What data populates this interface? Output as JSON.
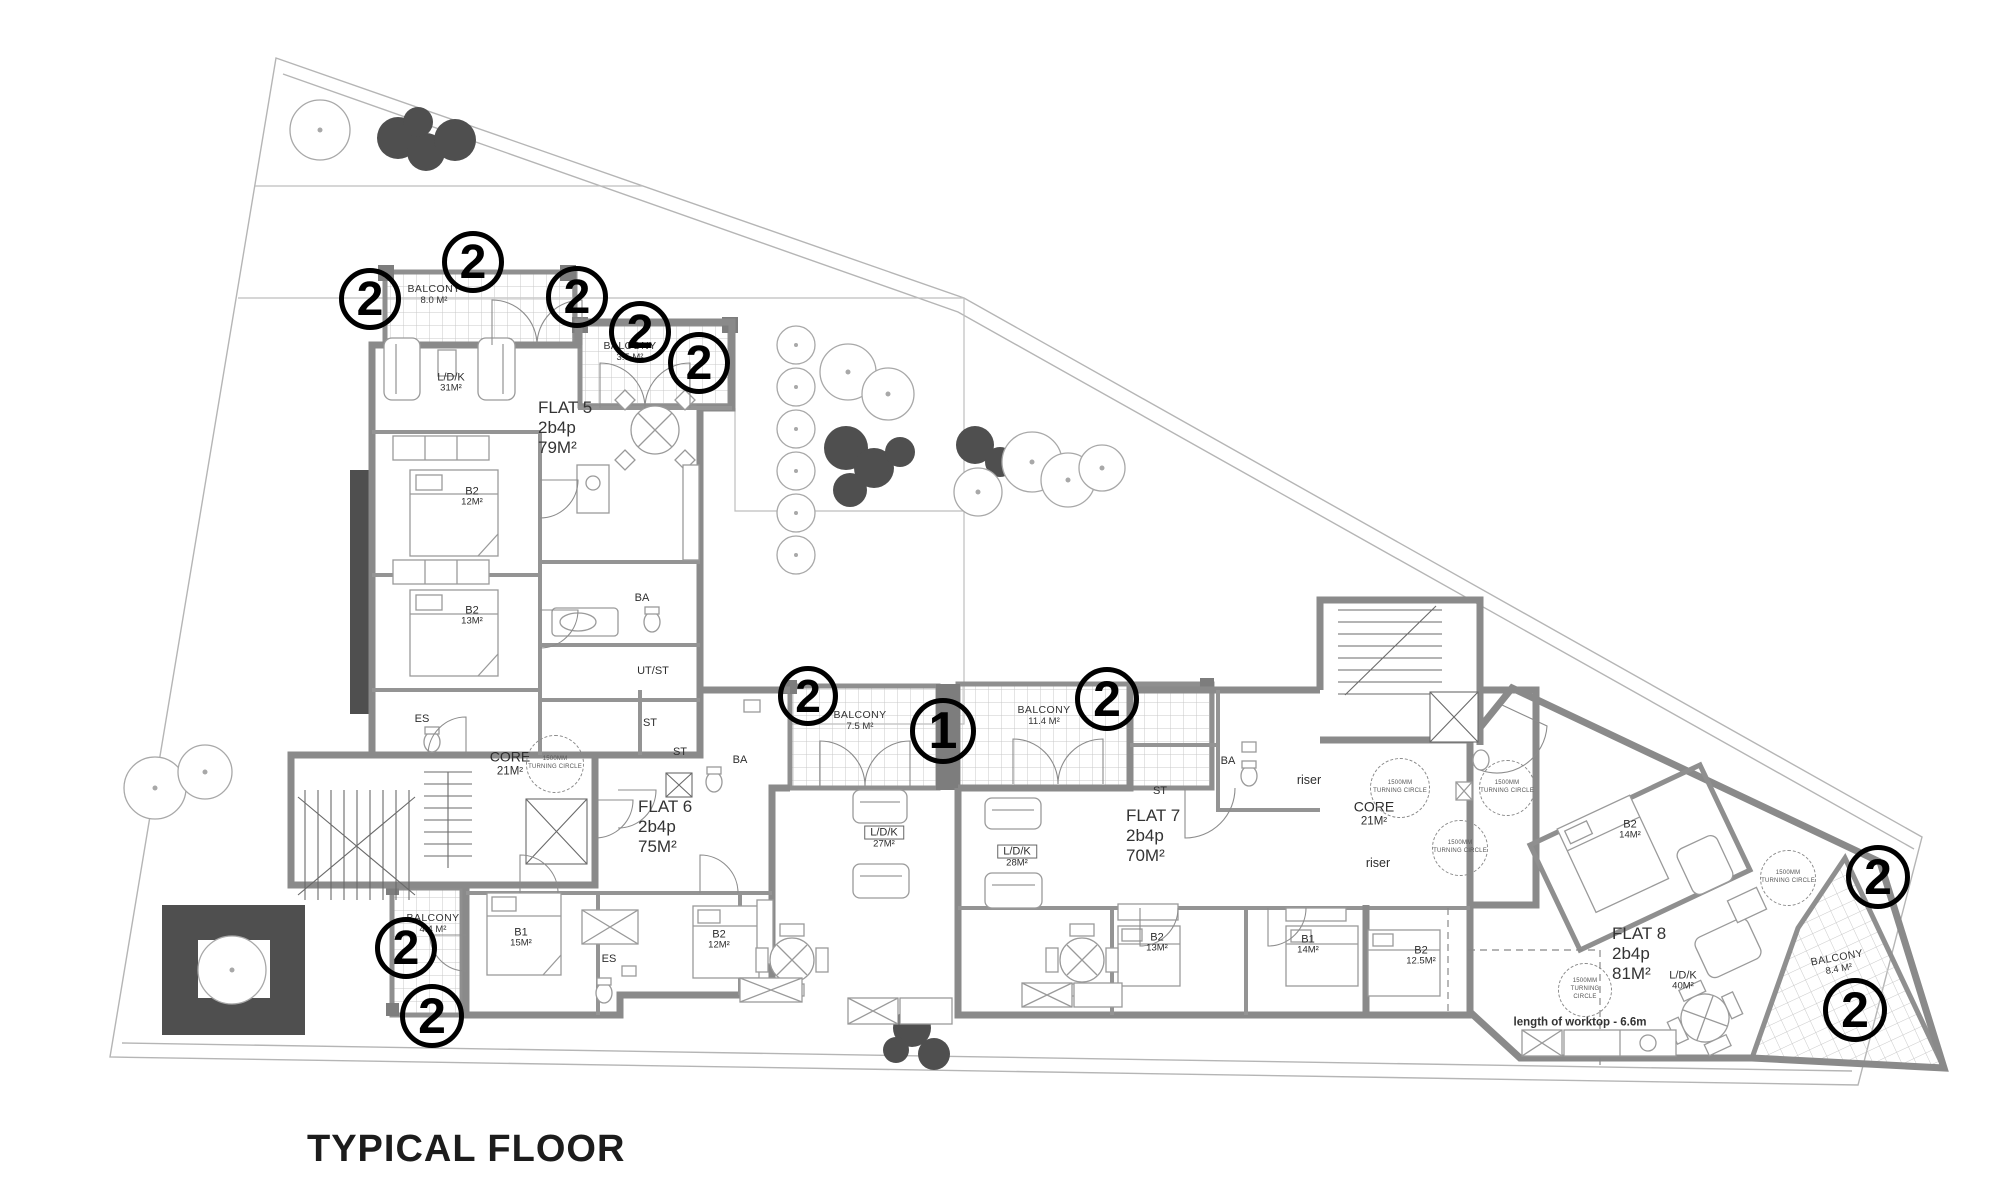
{
  "title": "TYPICAL FLOOR",
  "drawing": {
    "wall_color": "#8a8a8a",
    "hatch_color": "#c9c9c9",
    "tree_color": "#4f4f4f",
    "marker_color": "#000000",
    "title_pos": {
      "x": 307,
      "y": 1128
    }
  },
  "flats": [
    {
      "name": "FLAT 5",
      "occupancy": "2b4p",
      "area": "79M²",
      "x": 538,
      "y": 398
    },
    {
      "name": "FLAT 6",
      "occupancy": "2b4p",
      "area": "75M²",
      "x": 638,
      "y": 797
    },
    {
      "name": "FLAT 7",
      "occupancy": "2b4p",
      "area": "70M²",
      "x": 1126,
      "y": 806
    },
    {
      "name": "FLAT 8",
      "occupancy": "2b4p",
      "area": "81M²",
      "x": 1612,
      "y": 924
    }
  ],
  "labels": [
    {
      "text": "BALCONY",
      "sub": "8.0 M²",
      "x": 434,
      "y": 295,
      "cls": "balcony",
      "name": "balcony-label"
    },
    {
      "text": "BALCONY",
      "sub": "3.5 M²",
      "x": 630,
      "y": 352,
      "cls": "balcony",
      "name": "balcony-label"
    },
    {
      "text": "BALCONY",
      "sub": "7.5 M²",
      "x": 860,
      "y": 721,
      "cls": "balcony",
      "name": "balcony-label"
    },
    {
      "text": "BALCONY",
      "sub": "11.4 M²",
      "x": 1044,
      "y": 716,
      "cls": "balcony",
      "name": "balcony-label"
    },
    {
      "text": "BALCONY",
      "sub": "4.4 M²",
      "x": 433,
      "y": 924,
      "cls": "balcony",
      "name": "balcony-label"
    },
    {
      "text": "BALCONY",
      "sub": "8.4 M²",
      "x": 1838,
      "y": 964,
      "cls": "balcony",
      "rot": -10,
      "name": "balcony-label"
    },
    {
      "text": "L/D/K",
      "sub": "31M²",
      "x": 451,
      "y": 383,
      "name": "room-label"
    },
    {
      "text": "B2",
      "sub": "12M²",
      "x": 472,
      "y": 497,
      "name": "room-label"
    },
    {
      "text": "B2",
      "sub": "13M²",
      "x": 472,
      "y": 616,
      "name": "room-label"
    },
    {
      "text": "BA",
      "x": 642,
      "y": 598,
      "name": "room-label"
    },
    {
      "text": "UT/ST",
      "x": 653,
      "y": 671,
      "name": "room-label"
    },
    {
      "text": "ES",
      "x": 422,
      "y": 719,
      "name": "room-label"
    },
    {
      "text": "CORE",
      "sub": "21M²",
      "x": 510,
      "y": 764,
      "cls": "big",
      "name": "core-label"
    },
    {
      "text": "ST",
      "x": 650,
      "y": 723,
      "name": "room-label"
    },
    {
      "text": "ST",
      "x": 680,
      "y": 752,
      "name": "room-label"
    },
    {
      "text": "BA",
      "x": 740,
      "y": 760,
      "name": "room-label"
    },
    {
      "text": "B1",
      "sub": "15M²",
      "x": 521,
      "y": 938,
      "name": "room-label"
    },
    {
      "text": "ES",
      "x": 609,
      "y": 959,
      "name": "room-label"
    },
    {
      "text": "B2",
      "sub": "12M²",
      "x": 719,
      "y": 940,
      "name": "room-label"
    },
    {
      "text": "L/D/K",
      "sub": "27M²",
      "x": 884,
      "y": 838,
      "cls": "boxed",
      "name": "room-label"
    },
    {
      "text": "L/D/K",
      "sub": "28M²",
      "x": 1017,
      "y": 857,
      "cls": "boxed",
      "name": "room-label"
    },
    {
      "text": "ST",
      "x": 1160,
      "y": 791,
      "name": "room-label"
    },
    {
      "text": "BA",
      "x": 1228,
      "y": 761,
      "name": "room-label"
    },
    {
      "text": "riser",
      "x": 1309,
      "y": 780,
      "cls": "lower",
      "name": "riser-label"
    },
    {
      "text": "CORE",
      "sub": "21M²",
      "x": 1374,
      "y": 814,
      "cls": "big",
      "name": "core-label"
    },
    {
      "text": "riser",
      "x": 1378,
      "y": 863,
      "cls": "lower",
      "name": "riser-label"
    },
    {
      "text": "B2",
      "sub": "13M²",
      "x": 1157,
      "y": 943,
      "name": "room-label"
    },
    {
      "text": "B1",
      "sub": "14M²",
      "x": 1308,
      "y": 945,
      "name": "room-label"
    },
    {
      "text": "B2",
      "sub": "12.5M²",
      "x": 1421,
      "y": 956,
      "name": "room-label"
    },
    {
      "text": "B2",
      "sub": "14M²",
      "x": 1630,
      "y": 830,
      "name": "room-label"
    },
    {
      "text": "L/D/K",
      "sub": "40M²",
      "x": 1683,
      "y": 981,
      "name": "room-label"
    },
    {
      "text": "length of worktop - 6.6m",
      "x": 1580,
      "y": 1023,
      "cls": "note",
      "name": "worktop-note"
    }
  ],
  "markers": [
    {
      "v": "2",
      "x": 370,
      "y": 299,
      "r": 31
    },
    {
      "v": "2",
      "x": 473,
      "y": 262,
      "r": 31
    },
    {
      "v": "2",
      "x": 577,
      "y": 297,
      "r": 31
    },
    {
      "v": "2",
      "x": 640,
      "y": 332,
      "r": 31
    },
    {
      "v": "2",
      "x": 699,
      "y": 363,
      "r": 31
    },
    {
      "v": "2",
      "x": 808,
      "y": 696,
      "r": 30
    },
    {
      "v": "1",
      "x": 943,
      "y": 731,
      "r": 33
    },
    {
      "v": "2",
      "x": 1107,
      "y": 699,
      "r": 32
    },
    {
      "v": "2",
      "x": 406,
      "y": 948,
      "r": 31
    },
    {
      "v": "2",
      "x": 432,
      "y": 1016,
      "r": 32
    },
    {
      "v": "2",
      "x": 1878,
      "y": 877,
      "r": 32
    },
    {
      "v": "2",
      "x": 1855,
      "y": 1010,
      "r": 32
    }
  ],
  "turning_circles": {
    "line1": "1500MM",
    "line2": "TURNING CIRCLE",
    "items": [
      {
        "x": 555,
        "y": 764,
        "r": 29
      },
      {
        "x": 1400,
        "y": 788,
        "r": 30
      },
      {
        "x": 1507,
        "y": 788,
        "r": 28
      },
      {
        "x": 1460,
        "y": 848,
        "r": 28
      },
      {
        "x": 1788,
        "y": 878,
        "r": 28
      },
      {
        "x": 1585,
        "y": 990,
        "r": 27
      }
    ]
  }
}
